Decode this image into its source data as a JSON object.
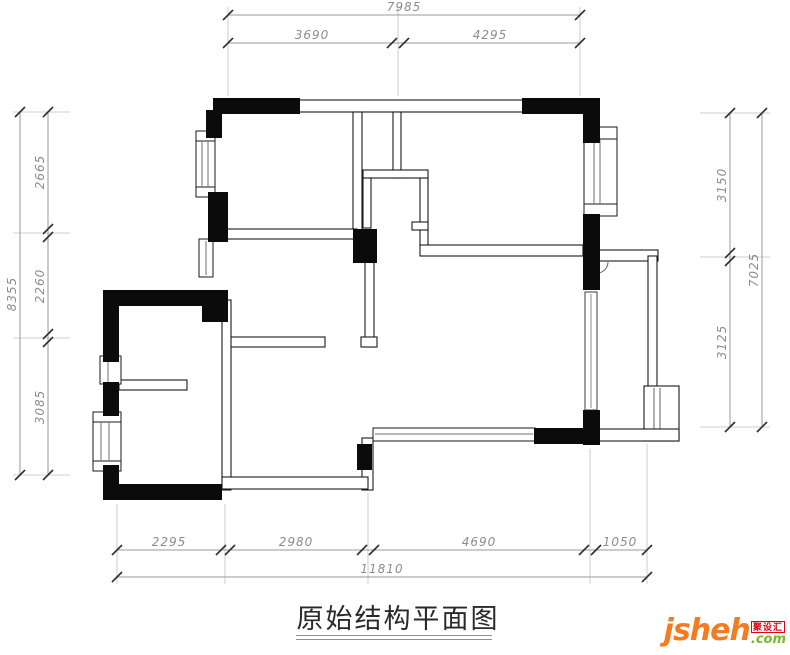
{
  "title": {
    "text": "原始结构平面图"
  },
  "logo": {
    "brand": "jsheh",
    "suffix": ".com",
    "cn_label": "聚设汇"
  },
  "colors": {
    "wall_solid": "#0b0b0b",
    "wall_line": "#1a1a1a",
    "dim_line": "#9a9a9a",
    "dim_text": "#8c8c8c",
    "brand_orange": "#f47b20",
    "brand_green": "#76b82a",
    "brand_red": "#e60012"
  },
  "dimensions": {
    "top": {
      "overall": "7985",
      "segments": [
        "3690",
        "4295"
      ]
    },
    "bottom": {
      "overall": "11810",
      "segments": [
        "2295",
        "2980",
        "4690",
        "1050"
      ]
    },
    "left": {
      "overall": "8355",
      "segments": [
        "2665",
        "2260",
        "3085"
      ]
    },
    "right": {
      "overall": "7025",
      "segments": [
        "3150",
        "3125"
      ]
    }
  }
}
